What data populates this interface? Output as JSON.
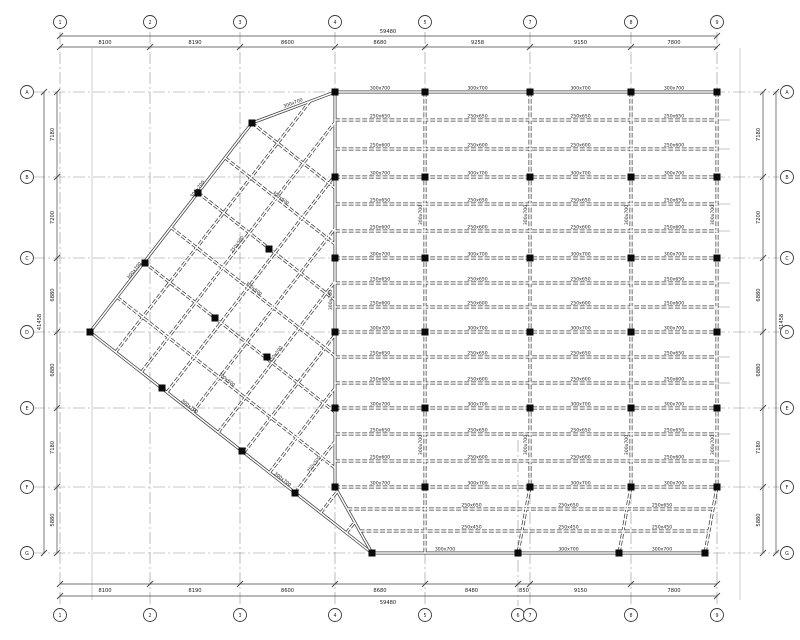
{
  "drawing": {
    "type": "structural-beam-framing-plan",
    "totals": {
      "horizontal": "59480",
      "vertical": "41458"
    },
    "dims_top": [
      "8100",
      "8190",
      "8600",
      "8680",
      "9258",
      "9150",
      "7800"
    ],
    "dims_bottom": [
      "8100",
      "8190",
      "8600",
      "8680",
      "8480",
      "850",
      "9150",
      "7800"
    ],
    "dims_left": [
      "7180",
      "7200",
      "6880",
      "6880",
      "7180",
      "5880"
    ],
    "dims_right": [
      "7180",
      "7200",
      "6880",
      "6880",
      "7180",
      "5880"
    ],
    "axis_labels": {
      "top": [
        "1",
        "2",
        "3",
        "4",
        "5",
        "7",
        "8",
        "9"
      ],
      "bottom": [
        "1",
        "2",
        "3",
        "4",
        "5",
        "6",
        "7",
        "8",
        "9"
      ],
      "left": [
        "A",
        "B",
        "C",
        "D",
        "E",
        "F",
        "G"
      ],
      "right": [
        "A",
        "B",
        "C",
        "D",
        "E",
        "F",
        "G"
      ]
    },
    "beam_sizes": {
      "main": "300x700",
      "secondary_upper": "250x650",
      "secondary_lower": "250x600",
      "bottom_bay_upper": "250x650",
      "bottom_bay_lower": "250x450",
      "vertical": "300x700",
      "diagonal_a": "250x500",
      "diagonal_b": "300x600",
      "boundary": "300x700"
    },
    "colors": {
      "beam": "#3f3f3f",
      "grid": "#8f8f8f",
      "column": "#0a0a0a",
      "text": "#222222",
      "dim": "#444444",
      "background": "#ffffff"
    }
  },
  "layout": {
    "canvas": [
      800,
      640
    ],
    "grid_xs": [
      60,
      150,
      240,
      335,
      425,
      530,
      631,
      717
    ],
    "grid_x_extra": 518,
    "grid_ys": [
      92,
      177,
      258,
      332,
      408,
      487
    ],
    "bottom_y": 553,
    "left_edge_x": 335,
    "right_edge_x": 717,
    "slant_drop": 12,
    "wedge": {
      "A": [
        335,
        92
      ],
      "B": [
        252,
        123
      ],
      "C": [
        90,
        332
      ],
      "D": [
        372,
        553
      ],
      "E": [
        335,
        487
      ]
    },
    "wedge_boundary_columns": [
      [
        252,
        123
      ],
      [
        198,
        193
      ],
      [
        145,
        263
      ],
      [
        90,
        332
      ],
      [
        162,
        388
      ],
      [
        242,
        451
      ],
      [
        295,
        493
      ]
    ],
    "wedge_interior_columns": [
      [
        269,
        249
      ],
      [
        215,
        318
      ],
      [
        267,
        357
      ]
    ],
    "bottom_edge_columns": [
      [
        372,
        553
      ],
      [
        518,
        553
      ],
      [
        619,
        553
      ],
      [
        705,
        553
      ]
    ],
    "bubbles": {
      "top_y": 22,
      "bottom_y": 615,
      "left_x": 27,
      "right_x": 787,
      "r": 6.5
    },
    "chains": {
      "top_inner": 47,
      "top_outer": 36,
      "bottom_inner": 584,
      "bottom_outer": 596,
      "left_inner": 57,
      "left_outer": 44,
      "right_inner": 763,
      "right_outer": 776,
      "ext_left": 92,
      "ext_right": 740
    }
  }
}
